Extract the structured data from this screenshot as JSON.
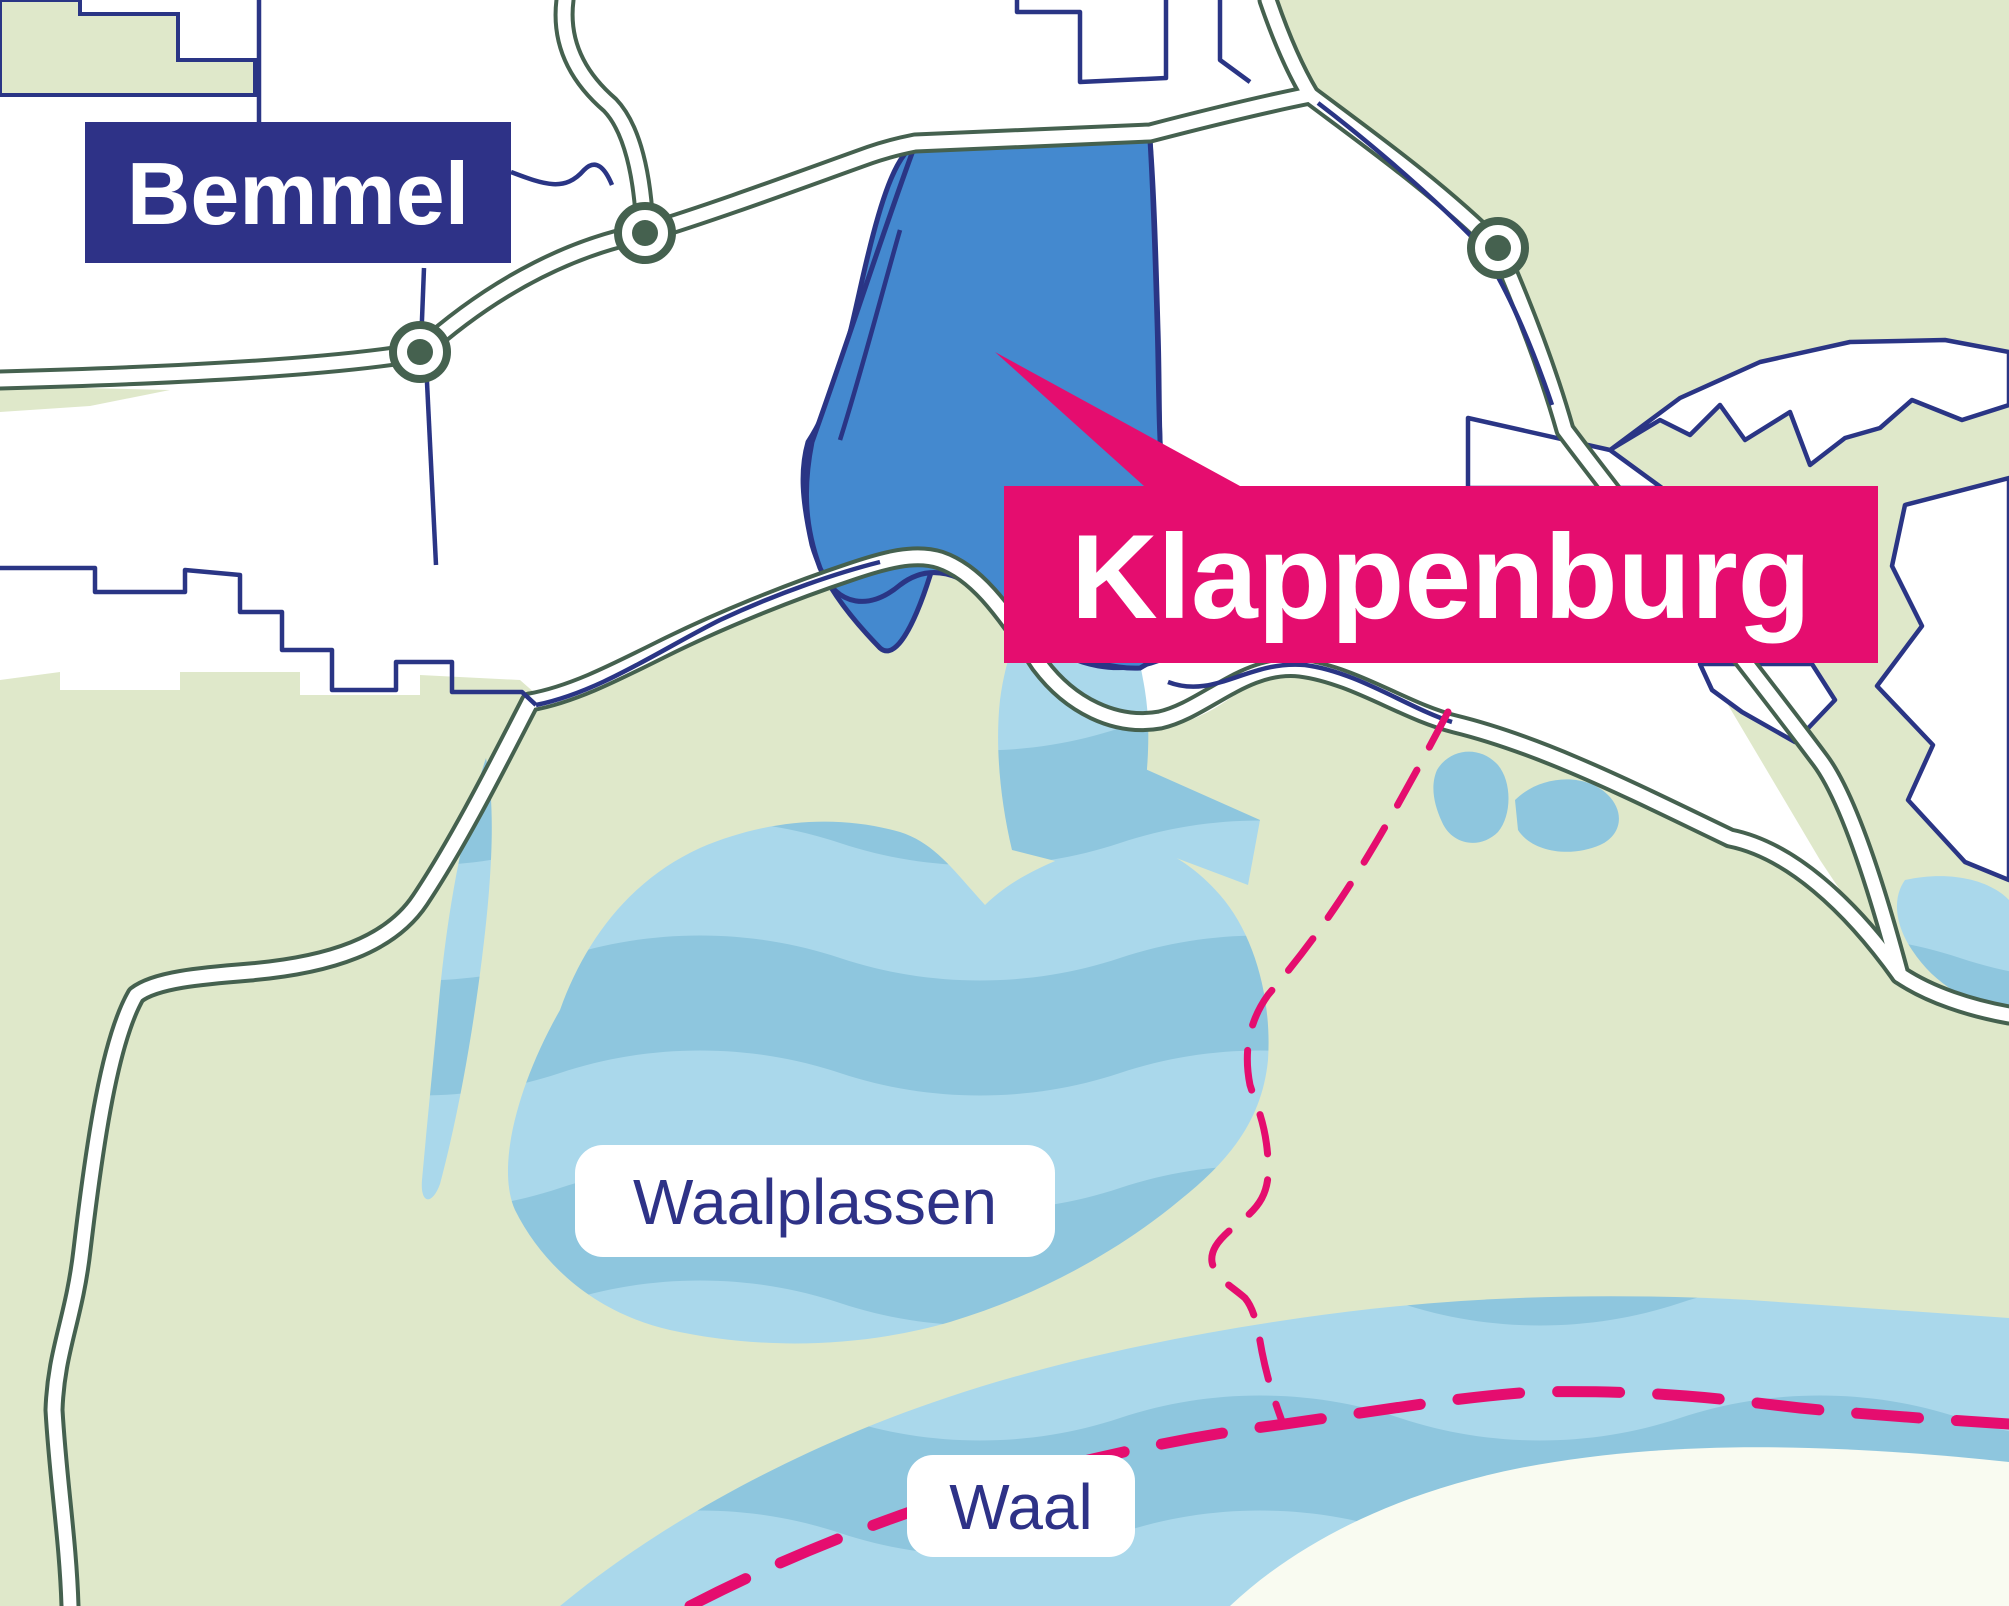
{
  "map": {
    "labels": {
      "bemmel": "Bemmel",
      "klappenburg": "Klappenburg",
      "waalplassen": "Waalplassen",
      "waal": "Waal"
    },
    "features": {
      "town_label": "Bemmel",
      "highlight_label": "Klappenburg",
      "lakes_label": "Waalplassen",
      "river_label": "Waal",
      "symbols": [
        "roundabout-marker",
        "road",
        "parcel-boundary",
        "municipal-border-dashed",
        "river-channel-dashed"
      ]
    },
    "colors": {
      "navy_line": "#2A3585",
      "navy_box": "#2E3287",
      "pink": "#E50D6F",
      "green": "#DFE8CA",
      "road_casing": "#45614F",
      "lake_light": "#AAD8EB",
      "lake_mid": "#8EC6DE",
      "klap_blue": "#4489CF",
      "sand": "#F9FBF1",
      "label_pill": "#FFFFFF"
    }
  }
}
